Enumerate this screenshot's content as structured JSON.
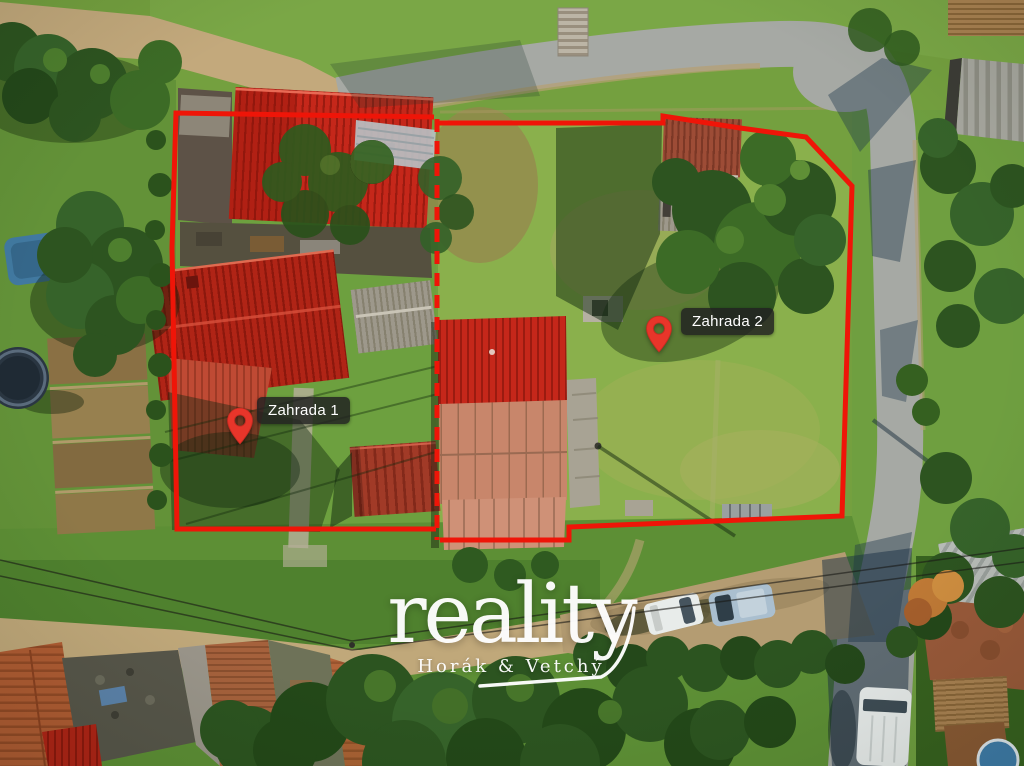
{
  "photo": {
    "type": "aerial-drone-property-photo",
    "markers": [
      {
        "id": "zahrada-1",
        "label": "Zahrada 1"
      },
      {
        "id": "zahrada-2",
        "label": "Zahrada 2"
      }
    ],
    "watermark": {
      "brand": "reality",
      "subtitle": "Horák & Vetchý"
    },
    "colors": {
      "boundary_red": "#ef1508",
      "pin_red": "#e8352a",
      "label_background": "rgba(33,33,33,0.84)",
      "label_text": "#ffffff",
      "watermark_white": "#ffffff"
    }
  }
}
